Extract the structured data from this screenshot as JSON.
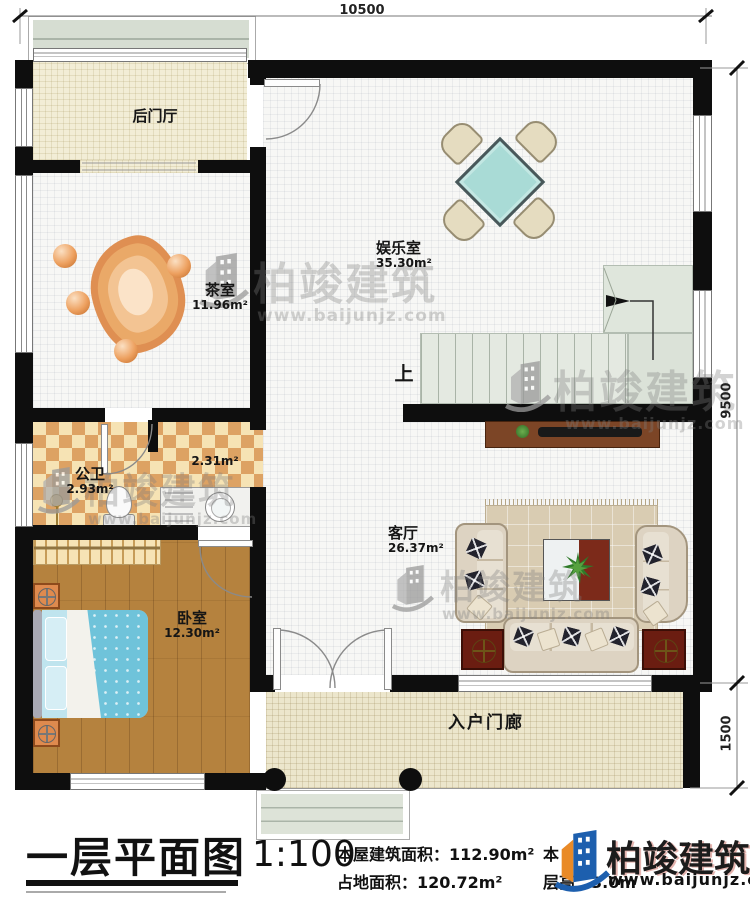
{
  "plan": {
    "dimensions": {
      "width_top": "10500",
      "height_right": "9500",
      "porch_height_right": "1500"
    },
    "rooms": [
      {
        "name": "后门厅",
        "area": ""
      },
      {
        "name": "茶室",
        "area": "11.96m²"
      },
      {
        "name": "娱乐室",
        "area": "35.30m²"
      },
      {
        "name": "公卫",
        "area": "2.93m²"
      },
      {
        "name": "",
        "area": "2.31m²"
      },
      {
        "name": "卧室",
        "area": "12.30m²"
      },
      {
        "name": "客厅",
        "area": "26.37m²"
      },
      {
        "name": "入户门廊",
        "area": ""
      }
    ],
    "stairs_up_label": "上"
  },
  "titleblock": {
    "title": "一层平面图",
    "scale": "1:100",
    "building_area": "本屋建筑面积：112.90m²",
    "land_area": "占地面积：120.72m²",
    "obscured_text": "本",
    "floor_height": "层高：3.0m"
  },
  "brand": {
    "name": "柏竣建筑",
    "url": "www.baijunjz.com"
  },
  "watermark": {
    "name": "柏竣建筑",
    "url": "www.baijunjz.com"
  },
  "colors": {
    "wall": "#0e0e0e",
    "logo_blue": "#1d5fae",
    "logo_orange": "#e98a27",
    "table_teal": "#a9dbd6"
  }
}
